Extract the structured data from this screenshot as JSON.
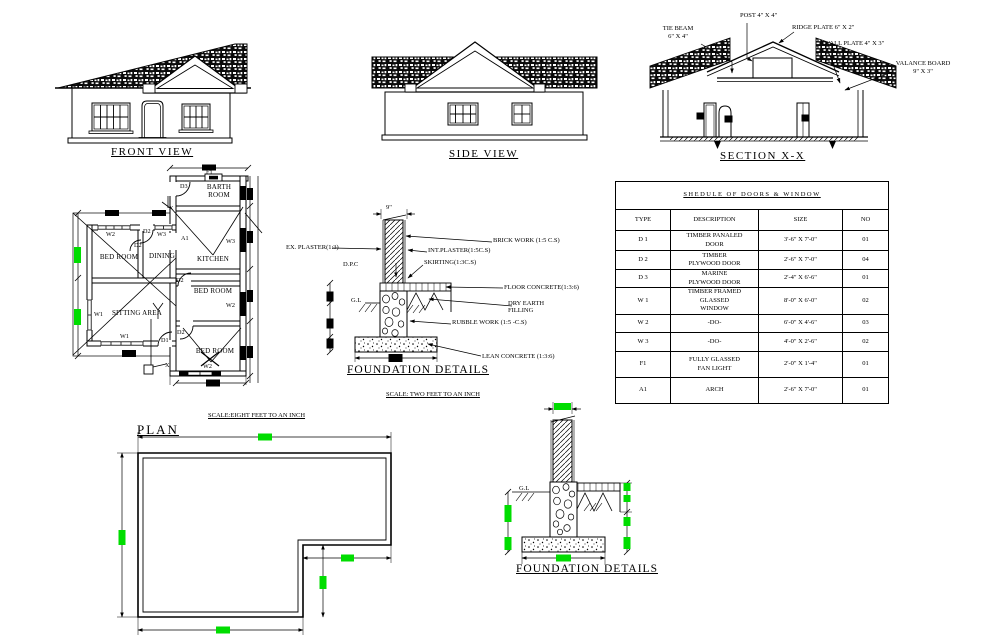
{
  "colors": {
    "line": "#000000",
    "highlight": "#00dd00",
    "background": "#ffffff"
  },
  "front_view": {
    "title": "FRONT VIEW"
  },
  "side_view": {
    "title": "SIDE VIEW"
  },
  "section": {
    "title": "SECTION X-X",
    "labels": {
      "tie_beam": "TIE BEAM\n6\" X 4\"",
      "post": "POST  4\" X 4\"",
      "ridge_plate": "RIDGE PLATE  6\" X 2\"",
      "wall_plate": "WALL PLATE 4\" X 3\"",
      "valance_board": "VALANCE BOARD\n9\" X 3\""
    }
  },
  "floor_plan": {
    "rooms": {
      "barth": "BARTH\nROOM",
      "kitchen": "KITCHEN",
      "bed1": "BED ROOM",
      "dining": "DINING",
      "bed2": "BED ROOM",
      "sitting": "SITTING AREA",
      "bed3": "BED ROOM"
    },
    "tags": {
      "f1": "F1",
      "d3": "D3",
      "x_top": "X",
      "w2_top": "W2",
      "d2_a": "D2",
      "w3_top": "W3",
      "a1": "A1",
      "d2_b": "D2",
      "w3_right": "W3",
      "d2_c": "D2",
      "w2_right": "W2",
      "w1_left": "W1",
      "w1_bottom": "W1",
      "d1": "D1",
      "d2_d": "D2",
      "x_bottom": "X",
      "w2_bottom": "W2"
    }
  },
  "foundation1": {
    "dim_top": "9\"",
    "ex_plaster": "EX. PLASTER(1:3)",
    "dpc": "D.P.C",
    "gl": "G.L",
    "brick_work": "BRICK WORK (1:5 C.S)",
    "int_plaster": "INT.PLASTER(1:5C.S)",
    "skirting": "SKIRTING(1:3C.S)",
    "floor_concrete": "FLOOR CONCRETE(1:3:6)",
    "dry_earth": "DRY EARTH\nFILLING",
    "rubble_work": "RUBBLE WORK (1:5 -C.S)",
    "lean_concrete": "LEAN CONCRETE (1:3:6)",
    "title": "FOUNDATION DETAILS",
    "scale_note": "SCALE: TWO FEET TO AN INCH"
  },
  "plan_outline": {
    "title": "PLAN",
    "scale_note": "SCALE:EIGHT FEET TO AN INCH"
  },
  "foundation2": {
    "gl": "G.L",
    "title": "FOUNDATION DETAILS"
  },
  "schedule": {
    "title": "SHEDULE OF DOORS & WINDOW",
    "columns": [
      "TYPE",
      "DESCRIPTION",
      "SIZE",
      "NO"
    ],
    "rows": [
      {
        "type": "D 1",
        "description": "TIMBER PANALED\nDOOR",
        "size": "3'-6\" X 7'-0\"",
        "no": "01"
      },
      {
        "type": "D 2",
        "description": "TIMBER\nPLYWOOD DOOR",
        "size": "2'-6\" X 7'-0\"",
        "no": "04"
      },
      {
        "type": "D 3",
        "description": "MARINE\nPLYWOOD DOOR",
        "size": "2'-4\" X 6'-6\"",
        "no": "01"
      },
      {
        "type": "W 1",
        "description": "TIMBER FRAMED\nGLASSED\nWINDOW",
        "size": "8'-0\" X 6'-0\"",
        "no": "02"
      },
      {
        "type": "W 2",
        "description": "-DO-",
        "size": "6'-0\" X 4'-6\"",
        "no": "03"
      },
      {
        "type": "W 3",
        "description": "-DO-",
        "size": "4'-0\" X 2'-6\"",
        "no": "02"
      },
      {
        "type": "F1",
        "description": "FULLY GLASSED\nFAN LIGHT",
        "size": "2'-0\" X 1'-4\"",
        "no": "01"
      },
      {
        "type": "A1",
        "description": "ARCH",
        "size": "2'-6\" X 7'-0\"",
        "no": "01"
      }
    ]
  }
}
